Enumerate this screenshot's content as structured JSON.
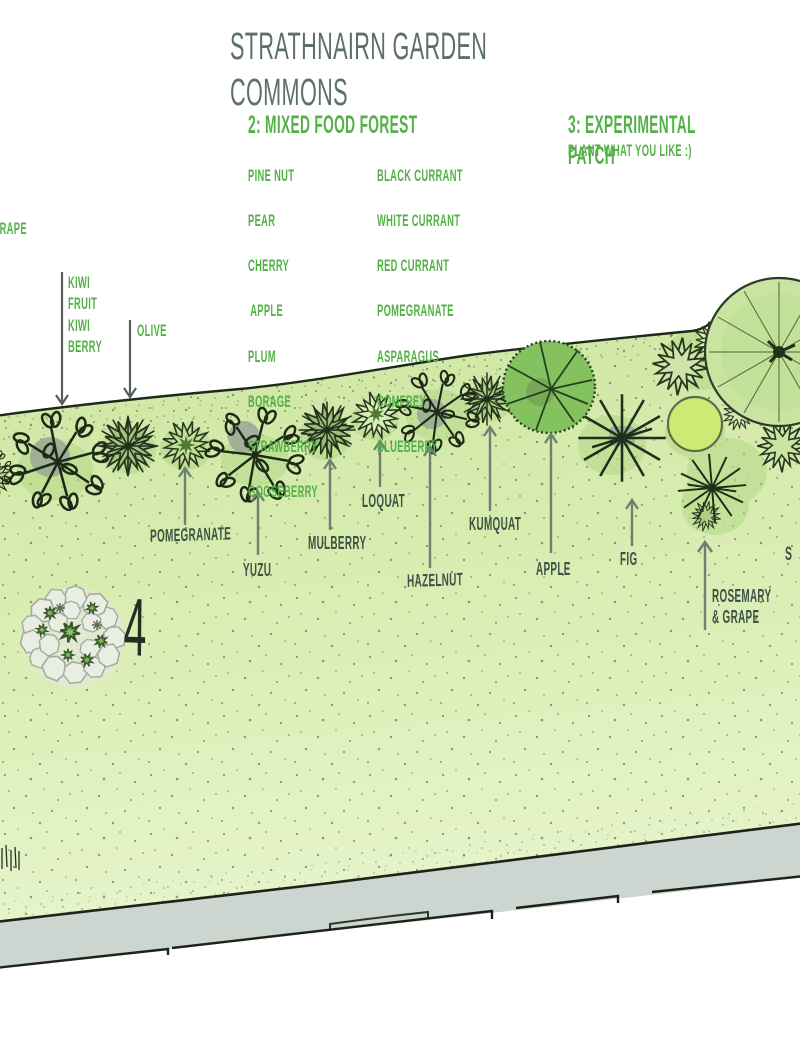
{
  "title": "STRATHNAIRN GARDEN COMMONS",
  "sections": {
    "food_forest": {
      "heading": "2: MIXED FOOD FOREST",
      "col1": [
        "PINE NUT",
        "PEAR",
        "CHERRY",
        "APPLE",
        "PLUM",
        "BORAGE",
        "STRAWBERRY",
        "GOOSEBERRY"
      ],
      "col2": [
        "BLACK CURRANT",
        "WHITE CURRANT",
        "RED CURRANT",
        "POMEGRANATE",
        "ASPARAGUS",
        "COMFREY",
        "BLUEBERRY"
      ]
    },
    "experimental": {
      "heading": "3: EXPERIMENTAL PATCH",
      "subtitle": "PLANT WHAT YOU LIKE :)"
    }
  },
  "plant_labels": {
    "grape": "GRAPE",
    "kiwi": "KIWI\nFRUIT\nKIWI\nBERRY",
    "olive": "OLIVE",
    "pomegranate": "POMEGRANATE",
    "yuzu": "YUZU",
    "mulberry": "MULBERRY",
    "loquat": "LOQUAT",
    "hazelnut": "HAZELNUT",
    "kumquat": "KUMQUAT",
    "apple": "APPLE",
    "fig": "FIG",
    "rosemary_grape": "ROSEMARY\n& GRAPE",
    "edge_partial": "S"
  },
  "zone_number": "4",
  "colors": {
    "title_gray": "#5d6f6a",
    "list_green": "#54b148",
    "label_green": "#3d5345",
    "arrow_gray": "#6e7f73",
    "bed_green": "#d6ebae",
    "walkway_gray": "#ccd5cf",
    "tree_green": "#84c25f",
    "outline_dark": "#26361f"
  }
}
